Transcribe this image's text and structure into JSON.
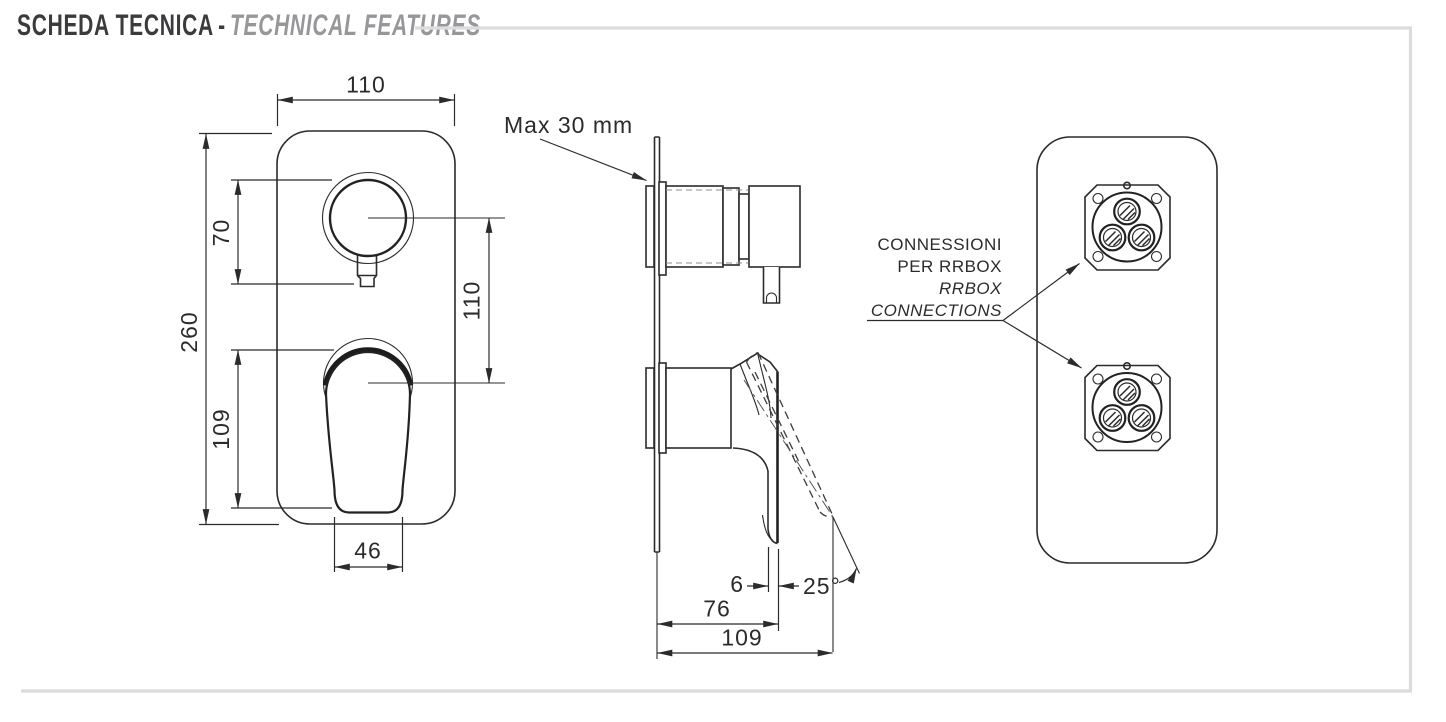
{
  "title": {
    "primary": "SCHEDA TECNICA",
    "separator": "-",
    "secondary": "TECHNICAL FEATURES"
  },
  "front_view": {
    "plate_width_mm": "110",
    "plate_height_mm": "260",
    "knob_offset_mm": "70",
    "handle_length_mm": "109",
    "centers_spacing_mm": "110",
    "handle_width_mm": "46"
  },
  "side_view": {
    "max_wall_thickness_label": "Max 30 mm",
    "handle_thickness_mm": "6",
    "depth_to_handle_mm": "76",
    "total_depth_mm": "109",
    "handle_opening_angle": "25°"
  },
  "back_view": {
    "label_line1": "CONNESSIONI",
    "label_line2": "PER RRBOX",
    "label_line3": "RRBOX",
    "label_line4": "CONNECTIONS"
  }
}
